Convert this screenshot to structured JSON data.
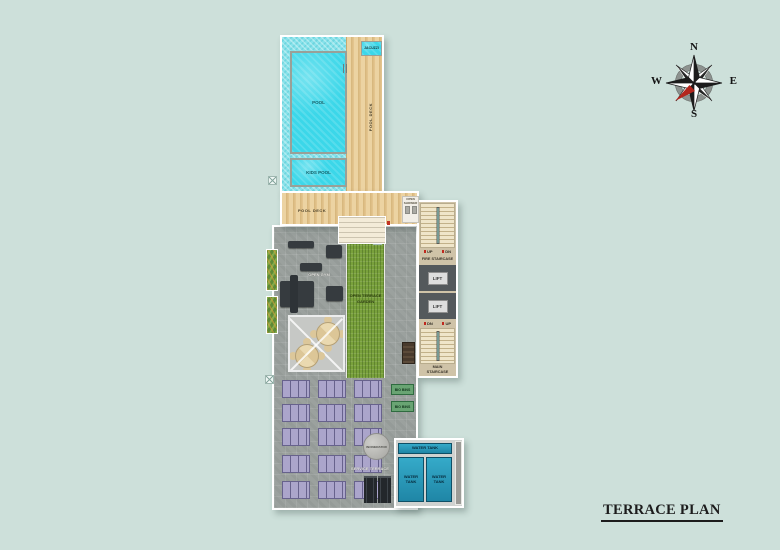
{
  "page": {
    "title": "TERRACE PLAN",
    "background": "#cde0da"
  },
  "compass": {
    "north": "N",
    "east": "E",
    "south": "S",
    "west": "W"
  },
  "pool_area": {
    "pool": "POOL",
    "kids_pool": "KIDS POOL",
    "jacuzzi": "JACUZZI",
    "deck_vertical": "POOL DECK",
    "deck_bottom": "POOL DECK"
  },
  "terrace": {
    "open_gym": "OPEN GYM",
    "garden_line1": "OPEN TERRACE",
    "garden_line2": "GARDEN",
    "open_shower": "OPEN SHOWER"
  },
  "core": {
    "fire_staircase": "FIRE STAIRCASE",
    "lift": "LIFT",
    "main_line1": "MAIN",
    "main_line2": "STAIRCASE",
    "up": "UP",
    "down": "DN"
  },
  "service": {
    "label": "SERVICE TERRACE",
    "incinerator": "INCINERATOR",
    "bio_bins": "BIO BINS",
    "water_tank": "WATER TANK"
  },
  "colors": {
    "background": "#cde0da",
    "pool_water": "#3bd7e9",
    "pool_tiles": "#86e2ea",
    "wood_deck": "#e6c995",
    "terrace_gray": "#9ba19e",
    "garden_green": "#79a13c",
    "solar_panel": "#aba5cb",
    "water_tank_blue": "#2598bb",
    "bio_bin_green": "#69a473",
    "compass_red": "#b3261d"
  }
}
